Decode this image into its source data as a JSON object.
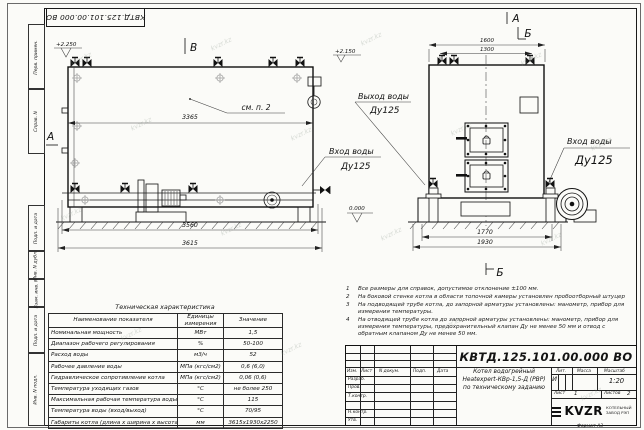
{
  "watermark": "kvzr.kz",
  "frame": {
    "doc_number_mirrored": "КВТД.125.101.00.000 ВО",
    "left_strip": [
      "Перв. примен.",
      "Справ. N",
      "Подп. и дата",
      "Инв. N дубл.",
      "Взам. инв. N",
      "Подп. и дата",
      "Инв. N подл."
    ],
    "format_label": "Формат А3"
  },
  "views": {
    "side": {
      "view_b": "В",
      "section_a": "А",
      "elev_top": "+2.250",
      "elev_zero": "0.000",
      "callout": "см. п. 2",
      "dim_inner": "3365",
      "dim_base": "3560",
      "dim_overall": "3615",
      "outlet_line1": "Выход воды",
      "outlet_line2": "Ду125",
      "inlet_line1": "Вход воды",
      "inlet_line2": "Ду125"
    },
    "front": {
      "label_a": "А",
      "label_b": "Б",
      "label_b_bottom": "Б",
      "elev_top": "+2.150",
      "dim_top_outer": "1600",
      "dim_top_inner": "1300",
      "dim_bottom_inner": "1770",
      "dim_bottom_outer": "1930",
      "inlet_line1": "Вход воды",
      "inlet_line2": "Ду125"
    }
  },
  "notes": [
    {
      "n": "1",
      "text": "Все размеры для справок, допустимое отклонение ±100 мм."
    },
    {
      "n": "2",
      "text": "На боковой стенке котла в области топочной камеры установлен пробоотборный штуцер"
    },
    {
      "n": "3",
      "text": "На подводящей трубе котла, до запорной арматуры установлены: манометр, прибор для измерения температуры."
    },
    {
      "n": "4",
      "text": "На отводящей трубе котла до запорной арматуры установлены: манометр, прибор для измерения температуры, предохранительный клапан Ду не менее 50 мм и отвод с обратным клапаном Ду не менее 50 мм."
    }
  ],
  "tech_table": {
    "title": "Техническая характеристика",
    "headers": [
      "Наименование показателя",
      "Единицы измерения",
      "Значение"
    ],
    "rows": [
      [
        "Номинальная мощность",
        "МВт",
        "1,5"
      ],
      [
        "Диапазон рабочего регулирования",
        "%",
        "50-100"
      ],
      [
        "Расход воды",
        "м3/ч",
        "52"
      ],
      [
        "Рабочее давление воды",
        "МПа (кгс/см2)",
        "0,6 (6,0)"
      ],
      [
        "Гидравлическое сопротивление котла",
        "МПа (кгс/см2)",
        "0,06 (0,6)"
      ],
      [
        "Температура уходящих газов",
        "°С",
        "не более 250"
      ],
      [
        "Максимальная рабочая температура воды",
        "°С",
        "115"
      ],
      [
        "Температура воды (вход/выход)",
        "°С",
        "70/95"
      ],
      [
        "Габариты котла (длина х ширина х высота)",
        "мм",
        "3615х1930х2250"
      ]
    ]
  },
  "title_block": {
    "doc_number": "КВТД.125.101.00.000 ВО",
    "change_cols": [
      "Изм.",
      "Лист",
      "N докум.",
      "Подп.",
      "Дата"
    ],
    "sig_rows": [
      "Разраб.",
      "Пров.",
      "Т.контр.",
      "",
      "Н.контр.",
      "Утв."
    ],
    "description": [
      "Котел водогрейный",
      "Heatexpert-КВр-1,5-Д (РВР)",
      "по техническому заданию"
    ],
    "lit_label": "Лит.",
    "lit_value": "И",
    "mass_label": "Масса",
    "scale_label": "Масштаб",
    "scale_value": "1:20",
    "sheet_label": "Лист",
    "sheet_value": "1",
    "sheets_label": "Листов",
    "sheets_value": "2",
    "logo": "KVZR",
    "logo_caption1": "КОТЕЛЬНЫЙ",
    "logo_caption2": "ЗАВОД РЭП"
  }
}
